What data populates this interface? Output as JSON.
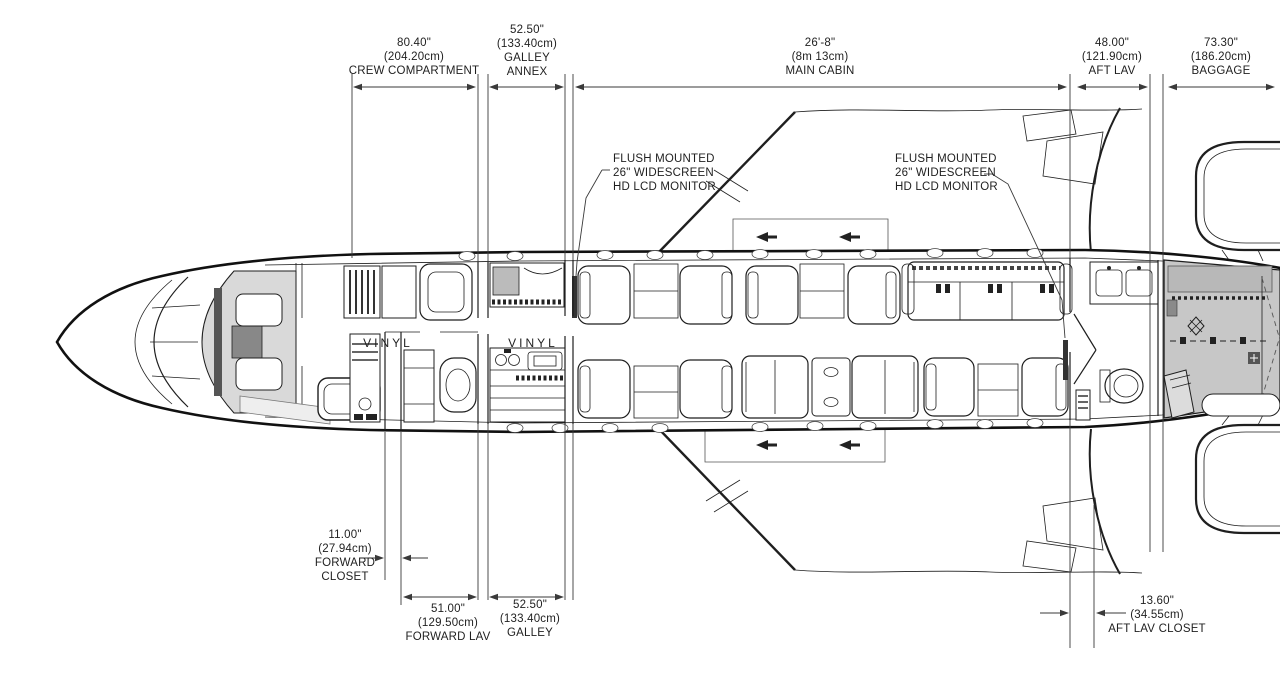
{
  "diagram": {
    "type": "aircraft-cabin-floorplan",
    "top_dimensions": [
      {
        "value": "80.40\"",
        "metric": "(204.20cm)",
        "label": "CREW COMPARTMENT"
      },
      {
        "value": "52.50\"",
        "metric": "(133.40cm)",
        "label": "GALLEY",
        "label2": "ANNEX"
      },
      {
        "value": "26'-8\"",
        "metric": "(8m 13cm)",
        "label": "MAIN CABIN"
      },
      {
        "value": "48.00\"",
        "metric": "(121.90cm)",
        "label": "AFT LAV"
      },
      {
        "value": "73.30\"",
        "metric": "(186.20cm)",
        "label": "BAGGAGE"
      }
    ],
    "bottom_dimensions": [
      {
        "value": "11.00\"",
        "metric": "(27.94cm)",
        "label": "FORWARD",
        "label2": "CLOSET"
      },
      {
        "value": "51.00\"",
        "metric": "(129.50cm)",
        "label": "FORWARD LAV"
      },
      {
        "value": "52.50\"",
        "metric": "(133.40cm)",
        "label": "GALLEY"
      },
      {
        "value": "13.60\"",
        "metric": "(34.55cm)",
        "label": "AFT LAV CLOSET"
      }
    ],
    "callouts": {
      "fwd_monitor": {
        "line1": "FLUSH MOUNTED",
        "line2": "26\" WIDESCREEN",
        "line3": "HD LCD MONITOR"
      },
      "aft_monitor": {
        "line1": "FLUSH MOUNTED",
        "line2": "26\" WIDESCREEN",
        "line3": "HD LCD MONITOR"
      }
    },
    "floor_labels": {
      "fwd": "VINYL",
      "mid": "VINYL"
    },
    "colors": {
      "line": "#1f1f1f",
      "dim_line": "#3a3a3a",
      "baggage_shade": "#c7c7c7",
      "cockpit_shade": "#d9d9d9",
      "background": "#ffffff"
    }
  }
}
